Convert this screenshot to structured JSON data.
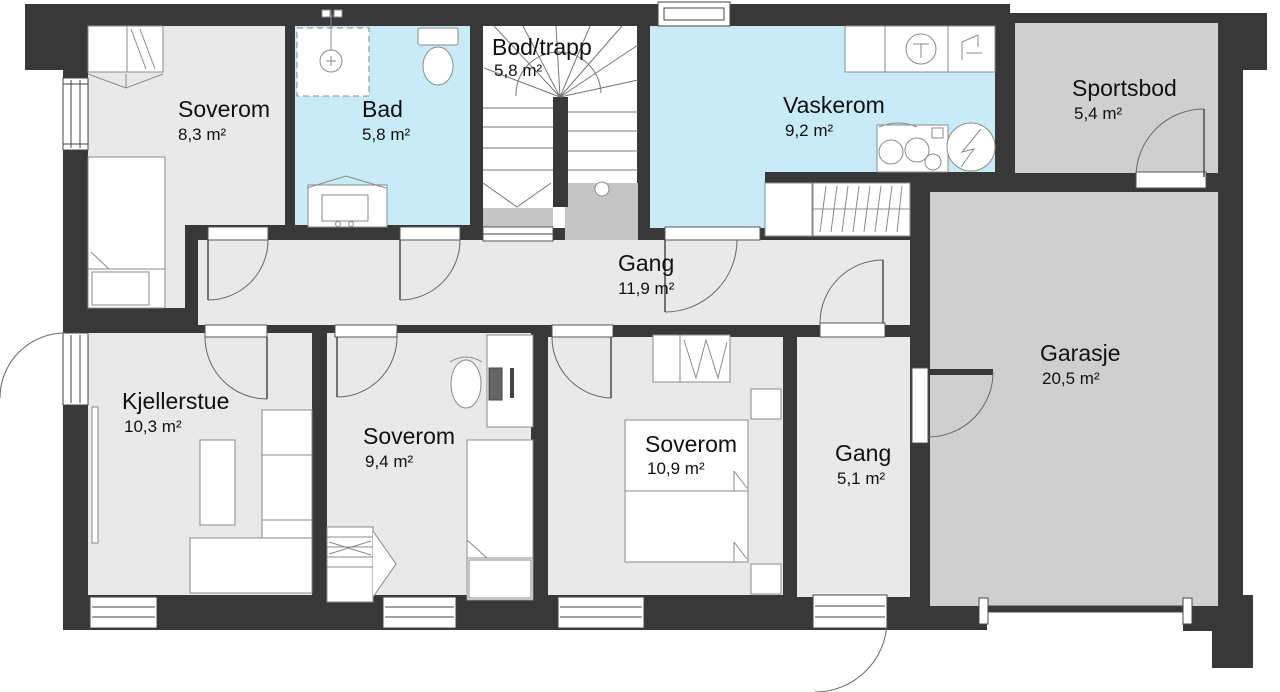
{
  "plan": {
    "type": "floor-plan",
    "floor": "basement",
    "rooms": {
      "soverom1": {
        "name": "Soverom",
        "area": "8,3 m²"
      },
      "bad": {
        "name": "Bad",
        "area": "5,8 m²"
      },
      "bod_trapp": {
        "name": "Bod/trapp",
        "area": "5,8 m²"
      },
      "vaskerom": {
        "name": "Vaskerom",
        "area": "9,2 m²"
      },
      "sportsbod": {
        "name": "Sportsbod",
        "area": "5,4 m²"
      },
      "gang1": {
        "name": "Gang",
        "area": "11,9 m²"
      },
      "kjellerstue": {
        "name": "Kjellerstue",
        "area": "10,3 m²"
      },
      "soverom2": {
        "name": "Soverom",
        "area": "9,4 m²"
      },
      "soverom3": {
        "name": "Soverom",
        "area": "10,9 m²"
      },
      "gang2": {
        "name": "Gang",
        "area": "5,1 m²"
      },
      "garasje": {
        "name": "Garasje",
        "area": "20,5 m²"
      }
    },
    "colors": {
      "wall": "#383838",
      "floor": "#e9e9e9",
      "wet_room": "#c8ebf7",
      "storage": "#cfcfcf",
      "stair_landing": "#c5c5c5",
      "stair_floor": "#ffffff",
      "background": "#ffffff"
    }
  }
}
